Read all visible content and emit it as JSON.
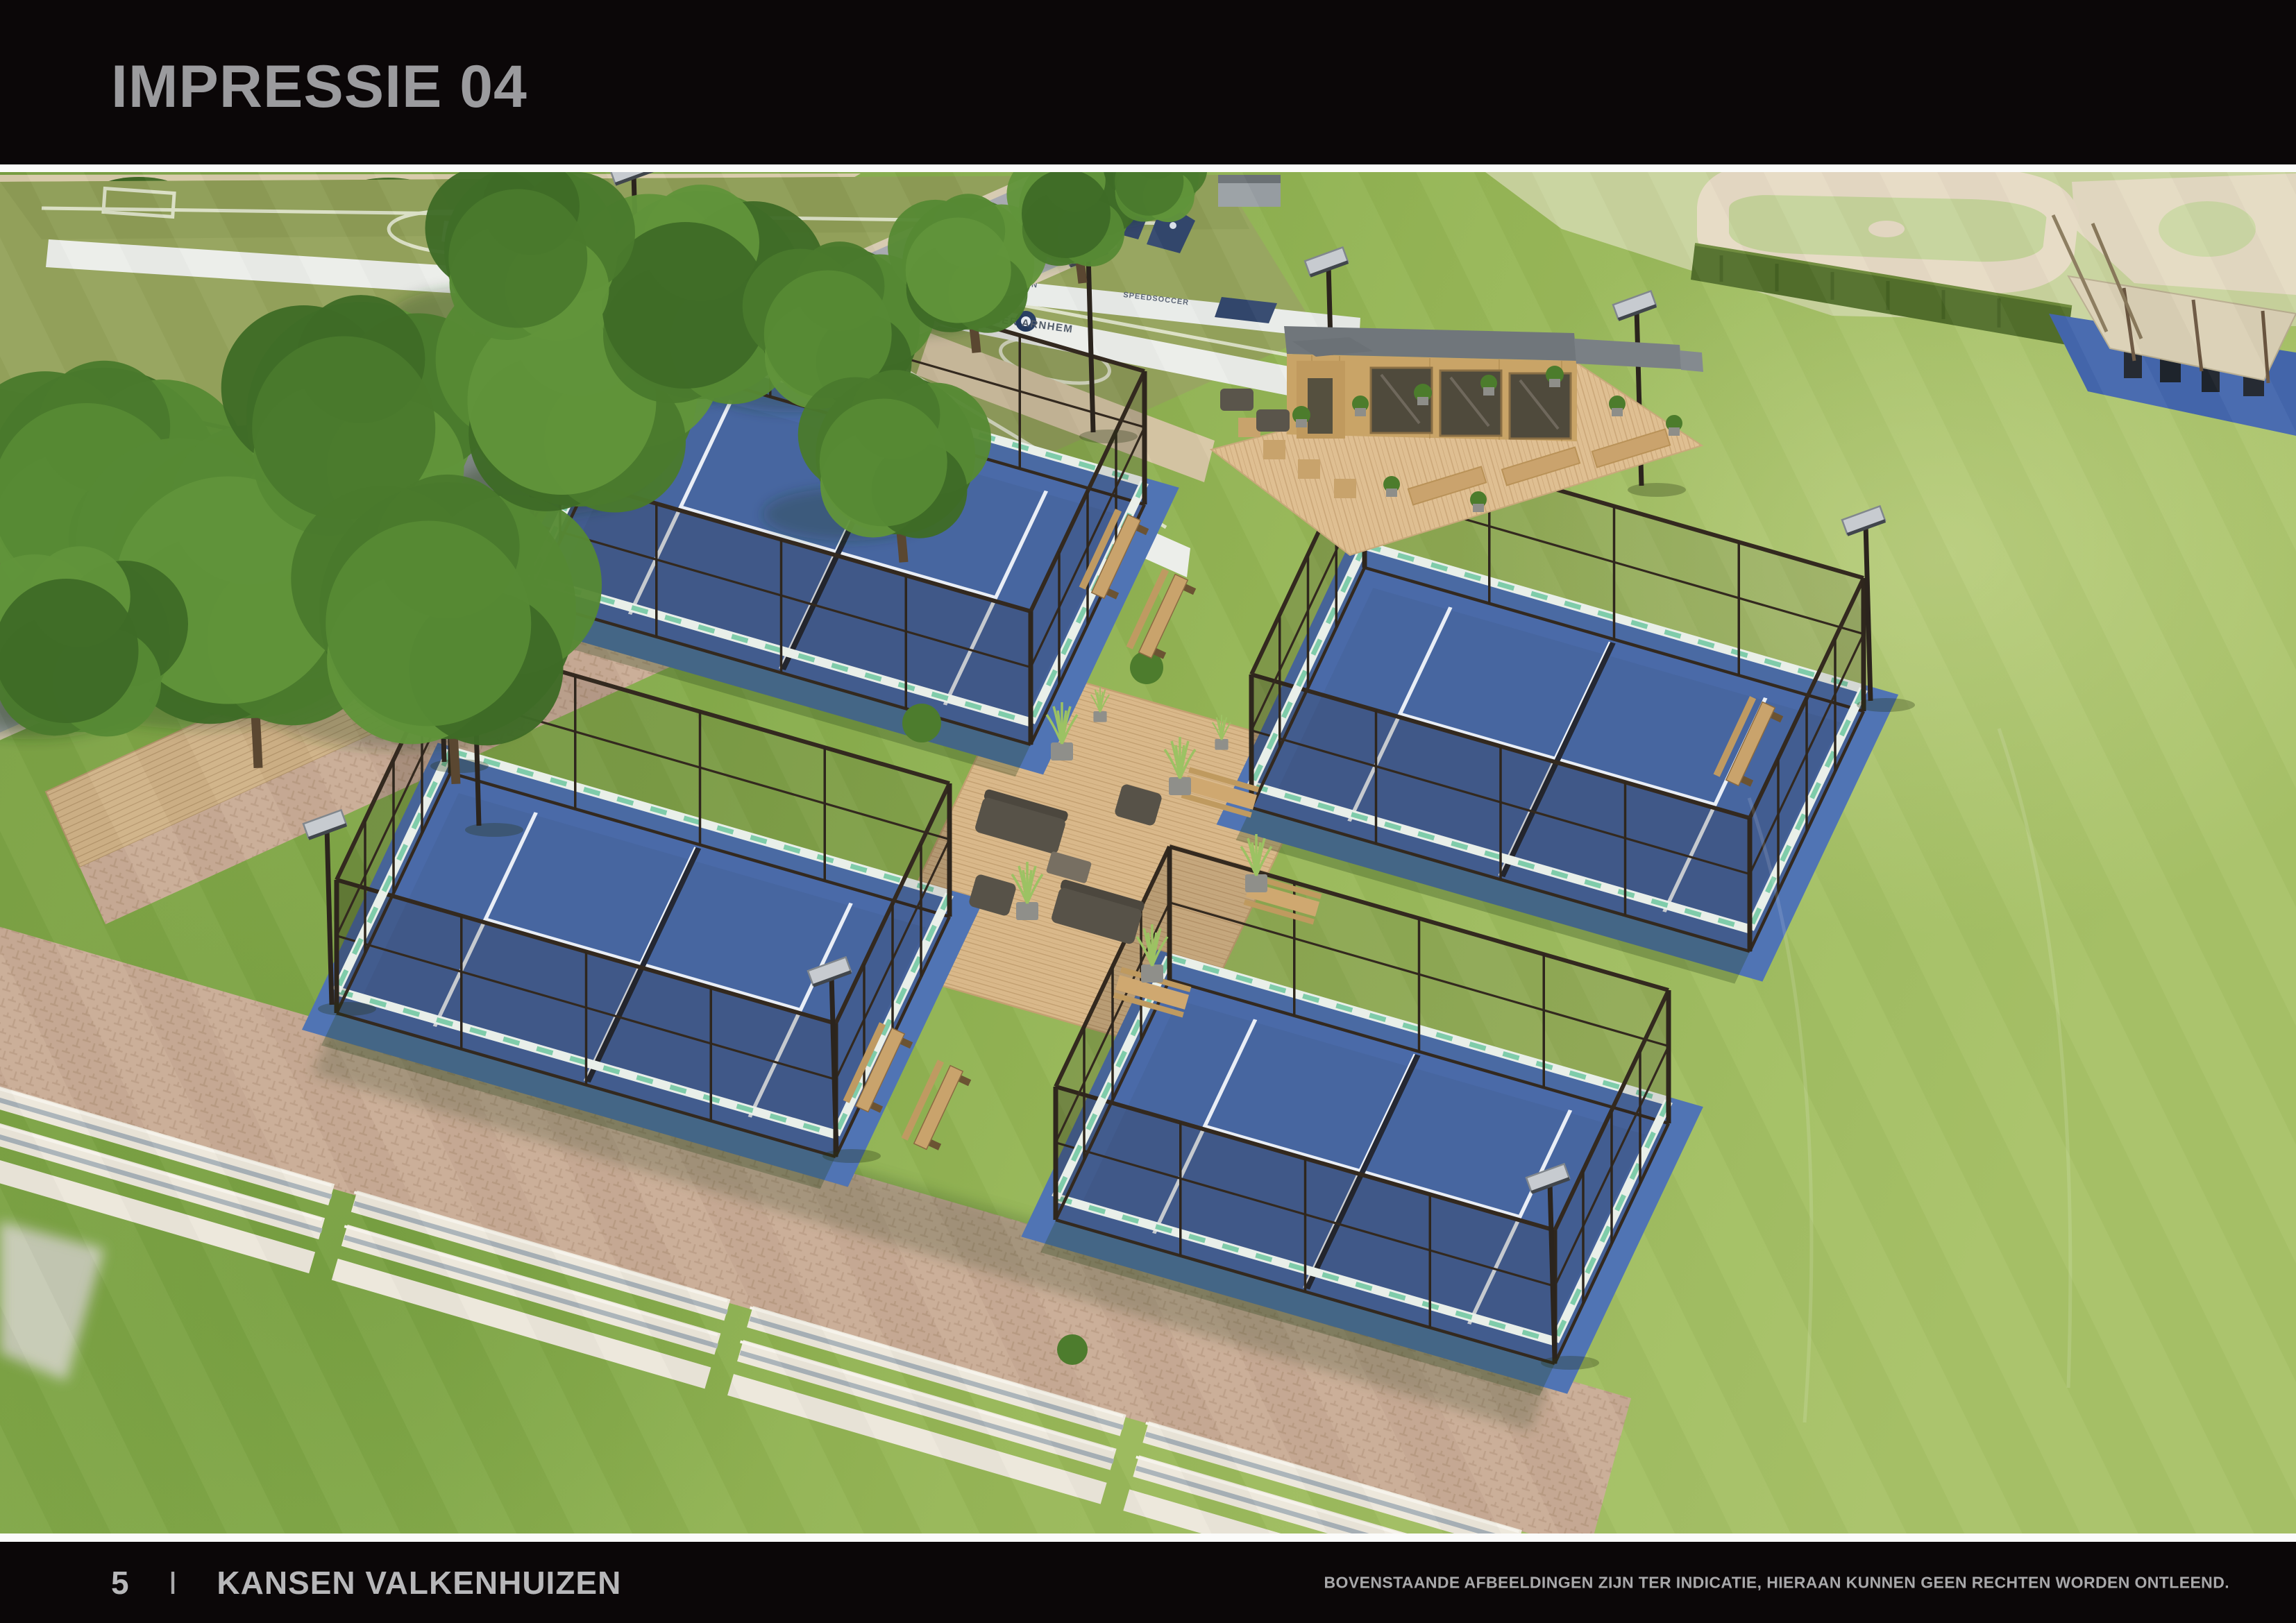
{
  "header": {
    "title": "IMPRESSIE 04"
  },
  "footer": {
    "page_number": "5",
    "separator": "I",
    "title": "KANSEN VALKENHUIZEN",
    "disclaimer": "BOVENSTAANDE AFBEELDINGEN ZIJN TER INDICATIE, HIERAAN KUNNEN GEEN RECHTEN WORDEN ONTLEEND."
  },
  "render": {
    "caption": "Aerial artist impression of four fenced padel courts with a central wooden lounge deck, clubhouse terrace, speedsoccer pitches, tree row, brick plaza with concrete seating steps, baseball field and outdoor gym",
    "labels": {
      "boarding_main": "SPEEDSOCCER ARNHEM",
      "boarding_far": "COMPETITION",
      "boarding_mid": "SPEEDSOCCER"
    },
    "palette": {
      "page_black": "#0b0708",
      "title_grey": "#9b9b9e",
      "footer_grey": "#b7b7b9",
      "grass": "#8fae4f",
      "grass_light": "#aac46a",
      "court_blue": "#4a6aa8",
      "fence_dark": "#322a21",
      "deck_wood": "#d9b88a",
      "brick": "#c9ac96",
      "concrete": "#ece7db",
      "road_grey": "#a7a8b0",
      "banner_teal": "#74c9a4",
      "tree_green": "#4a7a2d"
    }
  }
}
